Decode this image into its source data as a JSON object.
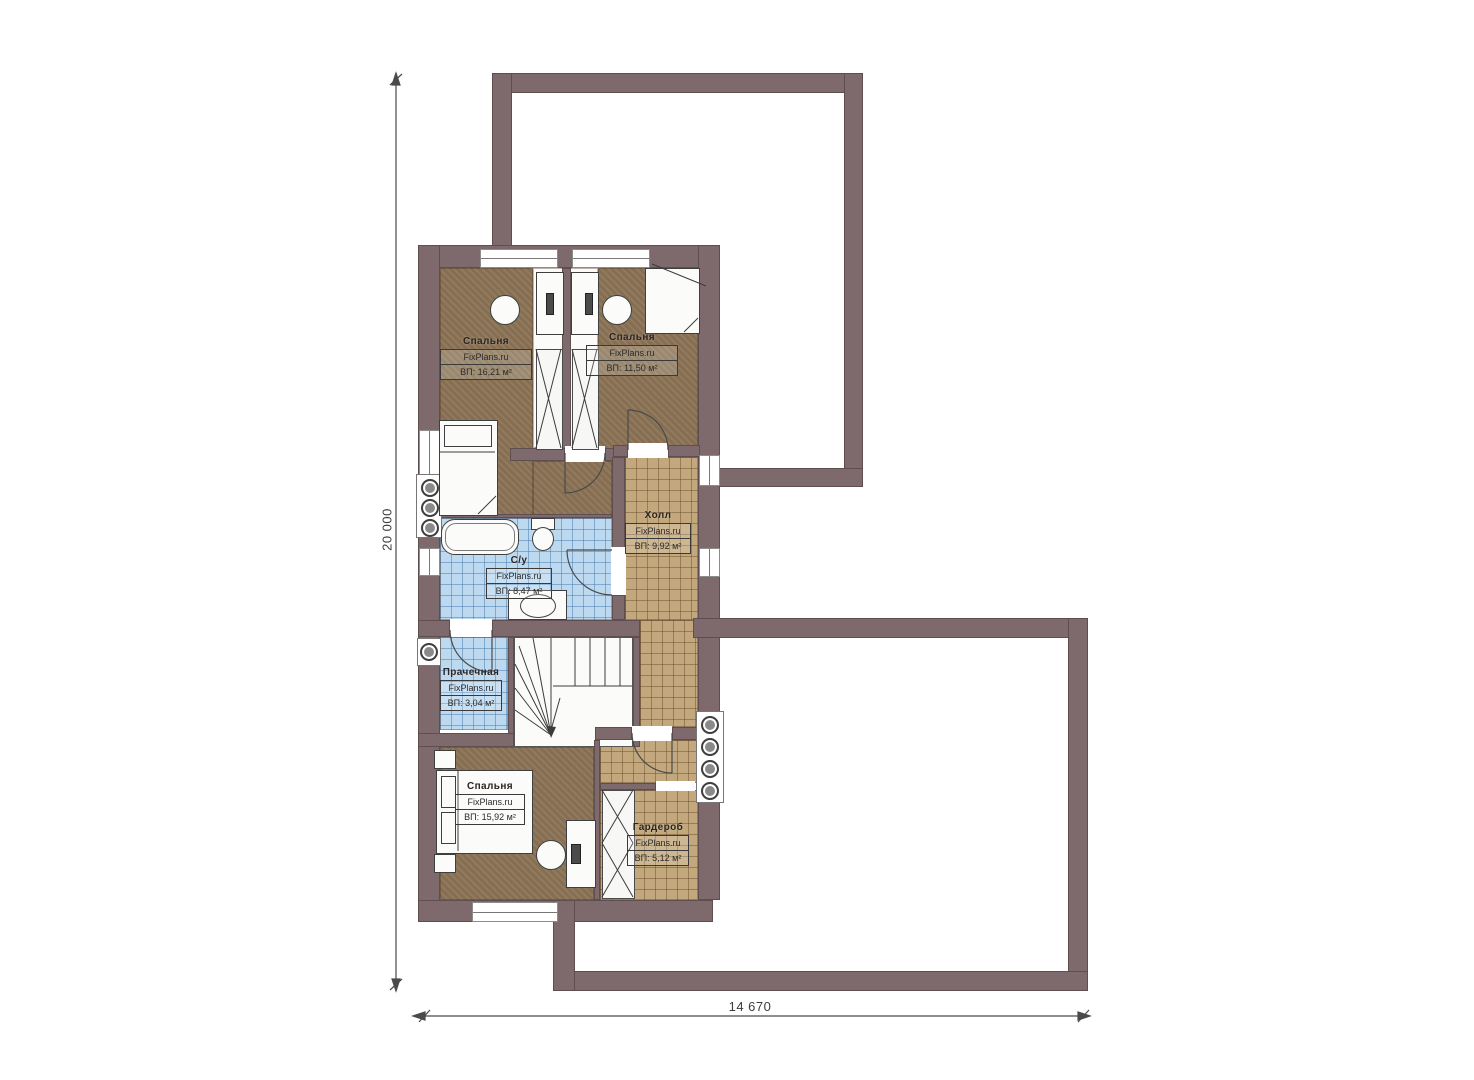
{
  "plan": {
    "title": "floor-plan-second-storey",
    "watermark": "FixPlans.ru",
    "dimensions": {
      "vertical": "20 000",
      "horizontal": "14 670"
    },
    "rooms": [
      {
        "name": "Спальня",
        "area": "ВП: 16,21 м²"
      },
      {
        "name": "Спальня",
        "area": "ВП: 11,50 м²"
      },
      {
        "name": "Холл",
        "area": "ВП: 9,92 м²"
      },
      {
        "name": "С/у",
        "area": "ВП: 8,47 м²"
      },
      {
        "name": "Прачечная",
        "area": "ВП: 3,04 м²"
      },
      {
        "name": "Спальня",
        "area": "ВП: 15,92 м²"
      },
      {
        "name": "Гардероб",
        "area": "ВП: 5,12 м²"
      }
    ],
    "colors": {
      "wall": "#7e6a6c",
      "bedroom": "#8b7355",
      "hall": "#c2a87c",
      "wet": "#bdd9f0"
    }
  }
}
